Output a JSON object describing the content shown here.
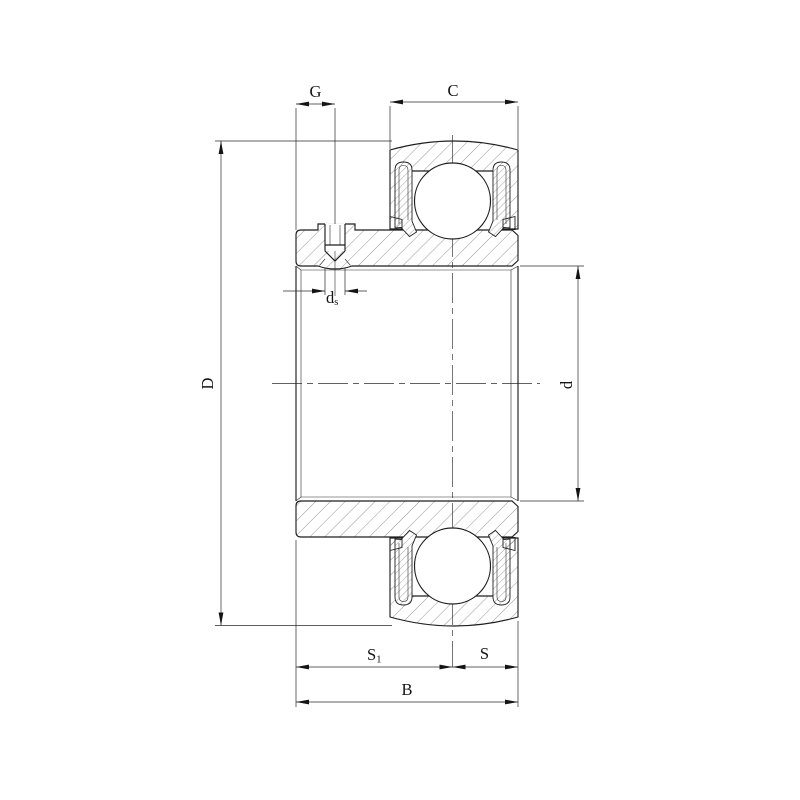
{
  "drawing": {
    "background": "#ffffff",
    "line_color": "#1f1f1f",
    "labels": {
      "g": "G",
      "c": "C",
      "outer_diameter": "D",
      "bore_diameter": "d",
      "set_screw_main": "d",
      "set_screw_sub": "s",
      "s1_main": "S",
      "s1_sub": "1",
      "s": "S",
      "b": "B"
    }
  }
}
